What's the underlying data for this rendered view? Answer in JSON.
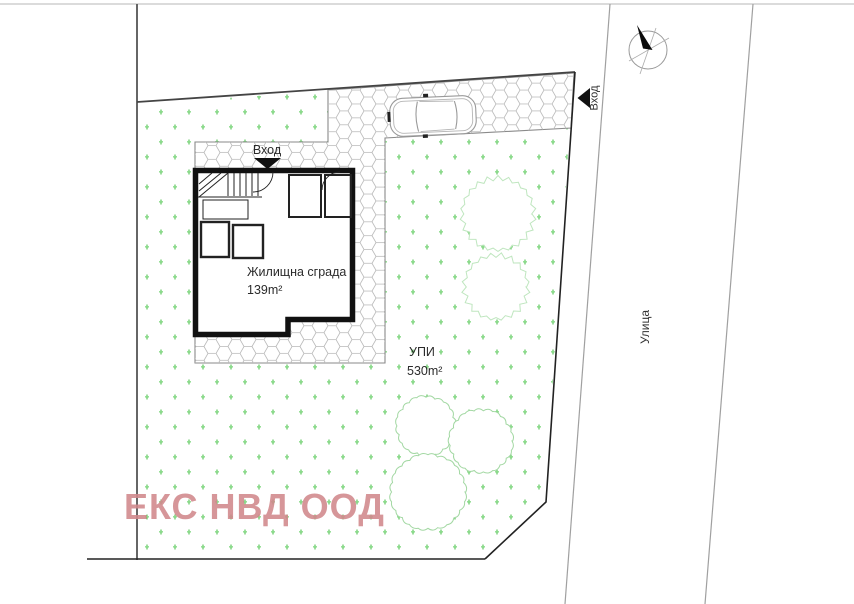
{
  "meta": {
    "type": "architectural-site-plan"
  },
  "labels": {
    "entrance_building": "Вход",
    "entrance_street": "Вход",
    "building_name": "Жилищна сграда",
    "building_area": "139m²",
    "plot_name": "УПИ",
    "plot_area": "530m²",
    "street_name": "Улица",
    "watermark": "ЕКС НВД ООД"
  },
  "icons": {
    "north_arrow": "compass-north-arrow",
    "entrance_marker_building": "triangle-arrow-down",
    "entrance_marker_street": "triangle-arrow-left"
  },
  "colors": {
    "grass_mark": "#4fc24f",
    "grass_mark_light": "#9ae49a",
    "tree_outline": "#bfe6bf",
    "bush_outline": "#a3d8a3",
    "pebble_line": "#b8b8b8",
    "pebble_edge": "#8a8a8a",
    "plot_boundary": "#222222",
    "north_boundary": "#444444",
    "left_boundary": "#666666",
    "street_line": "#a0a0a0",
    "building_wall": "#111111",
    "car_outline": "#9a9a9a",
    "watermark": "#d1888c",
    "text": "#2b2b2b"
  }
}
